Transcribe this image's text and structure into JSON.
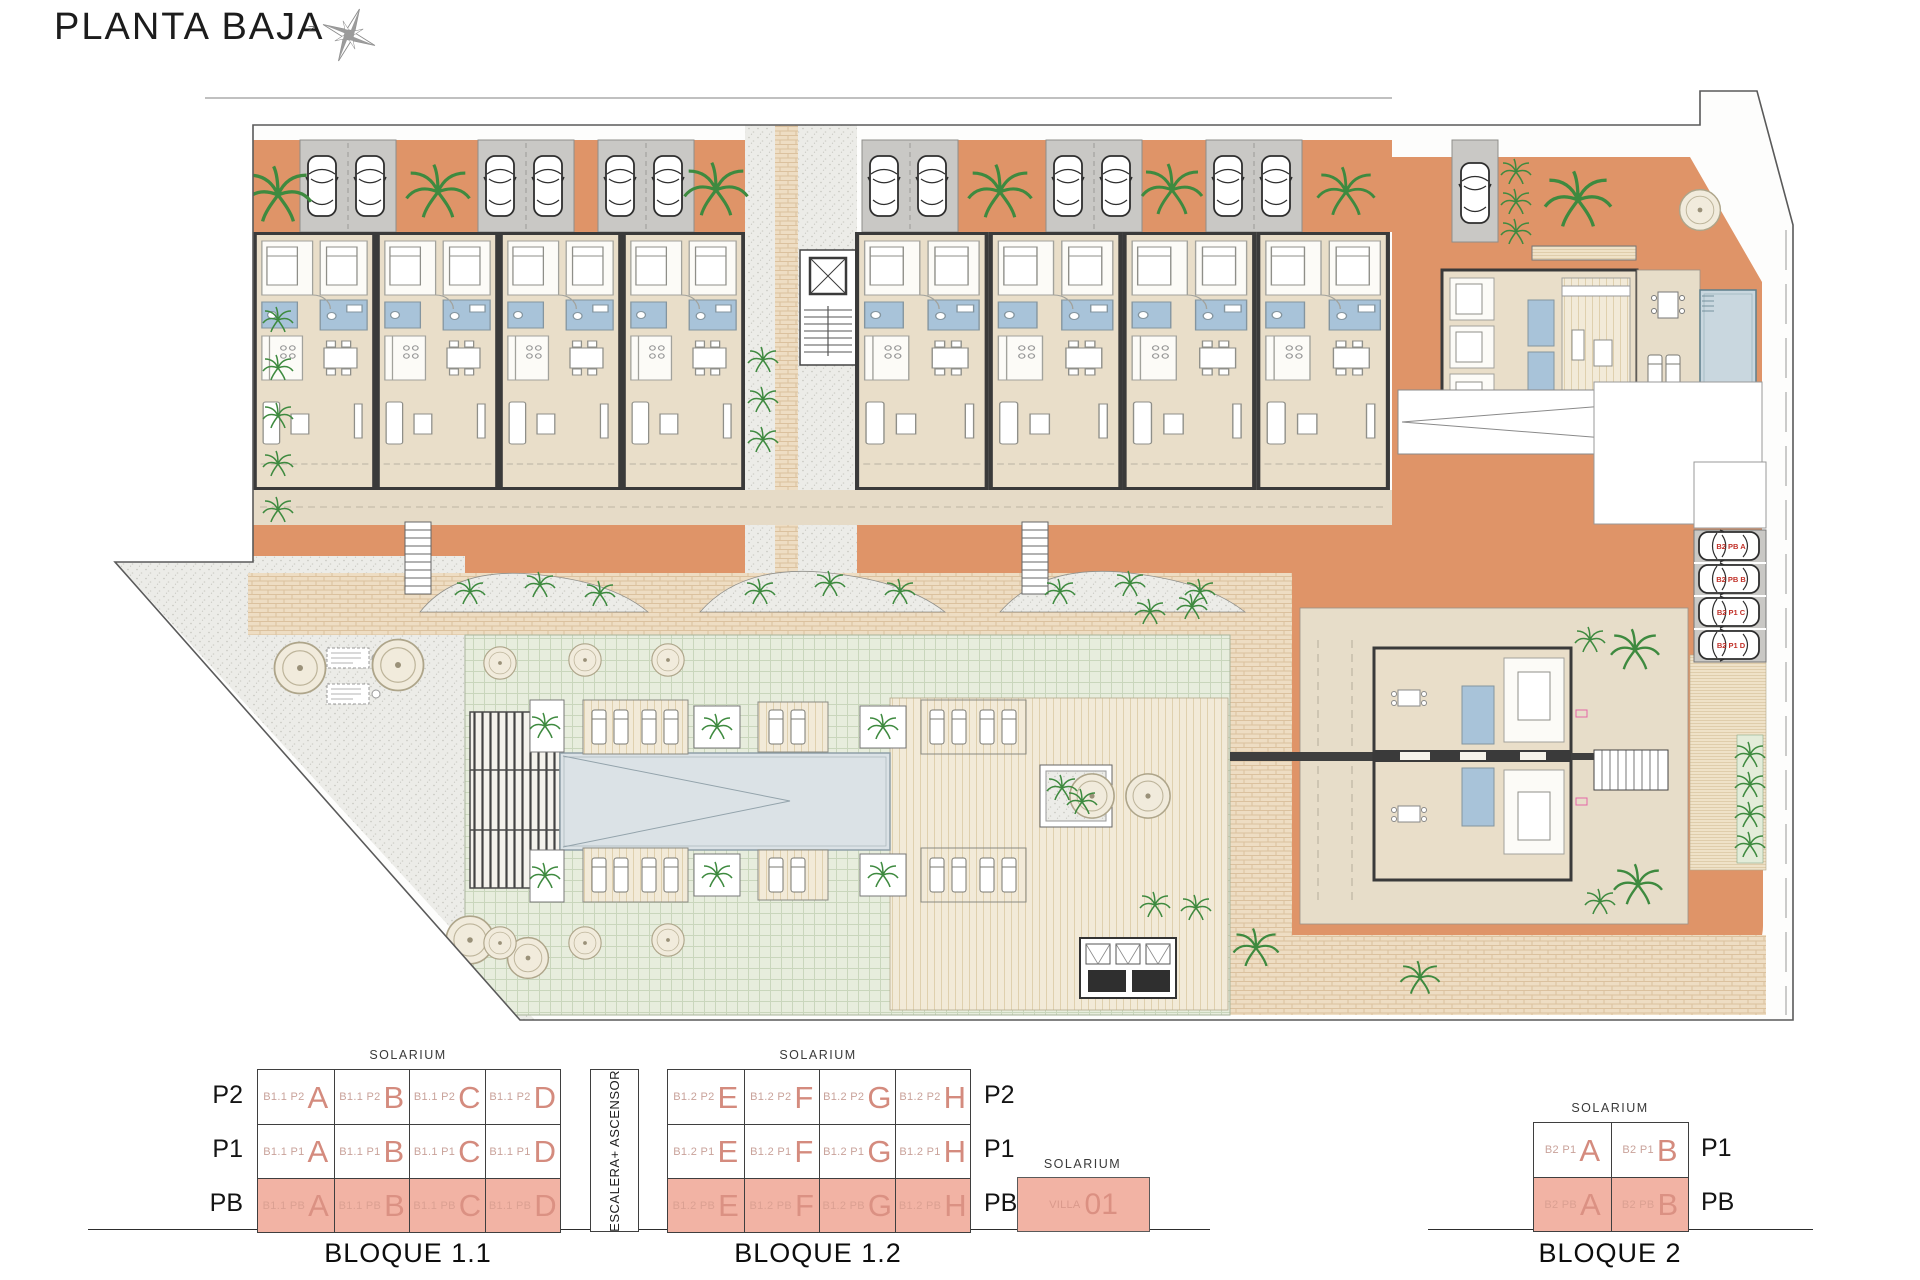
{
  "title": "PLANTA BAJA",
  "compass": {
    "north_label": "N"
  },
  "plan": {
    "parking_labels": [
      "B2 PB A",
      "B2 PB B",
      "B2 P1 C",
      "B2 P1 D"
    ]
  },
  "legend": {
    "solarium": "SOLARIUM",
    "escalera": "ESCALERA+ ASCENSOR",
    "floors3": [
      "P2",
      "P1",
      "PB"
    ],
    "floors2": [
      "P1",
      "PB"
    ],
    "b11": {
      "name": "BLOQUE 1.1",
      "cells": [
        {
          "code": "B1.1 P2",
          "letter": "A"
        },
        {
          "code": "B1.1 P2",
          "letter": "B"
        },
        {
          "code": "B1.1 P2",
          "letter": "C"
        },
        {
          "code": "B1.1 P2",
          "letter": "D"
        },
        {
          "code": "B1.1 P1",
          "letter": "A"
        },
        {
          "code": "B1.1 P1",
          "letter": "B"
        },
        {
          "code": "B1.1 P1",
          "letter": "C"
        },
        {
          "code": "B1.1 P1",
          "letter": "D"
        },
        {
          "code": "B1.1 PB",
          "letter": "A"
        },
        {
          "code": "B1.1 PB",
          "letter": "B"
        },
        {
          "code": "B1.1 PB",
          "letter": "C"
        },
        {
          "code": "B1.1 PB",
          "letter": "D"
        }
      ]
    },
    "b12": {
      "name": "BLOQUE 1.2",
      "cells": [
        {
          "code": "B1.2 P2",
          "letter": "E"
        },
        {
          "code": "B1.2 P2",
          "letter": "F"
        },
        {
          "code": "B1.2 P2",
          "letter": "G"
        },
        {
          "code": "B1.2 P2",
          "letter": "H"
        },
        {
          "code": "B1.2 P1",
          "letter": "E"
        },
        {
          "code": "B1.2 P1",
          "letter": "F"
        },
        {
          "code": "B1.2 P1",
          "letter": "G"
        },
        {
          "code": "B1.2 P1",
          "letter": "H"
        },
        {
          "code": "B1.2 PB",
          "letter": "E"
        },
        {
          "code": "B1.2 PB",
          "letter": "F"
        },
        {
          "code": "B1.2 PB",
          "letter": "G"
        },
        {
          "code": "B1.2 PB",
          "letter": "H"
        }
      ]
    },
    "b2": {
      "name": "BLOQUE 2",
      "cells": [
        {
          "code": "B2 P1",
          "letter": "A"
        },
        {
          "code": "B2 P1",
          "letter": "B"
        },
        {
          "code": "B2 PB",
          "letter": "A"
        },
        {
          "code": "B2 PB",
          "letter": "B"
        }
      ]
    },
    "villa": {
      "code": "VILLA",
      "number": "01"
    }
  }
}
